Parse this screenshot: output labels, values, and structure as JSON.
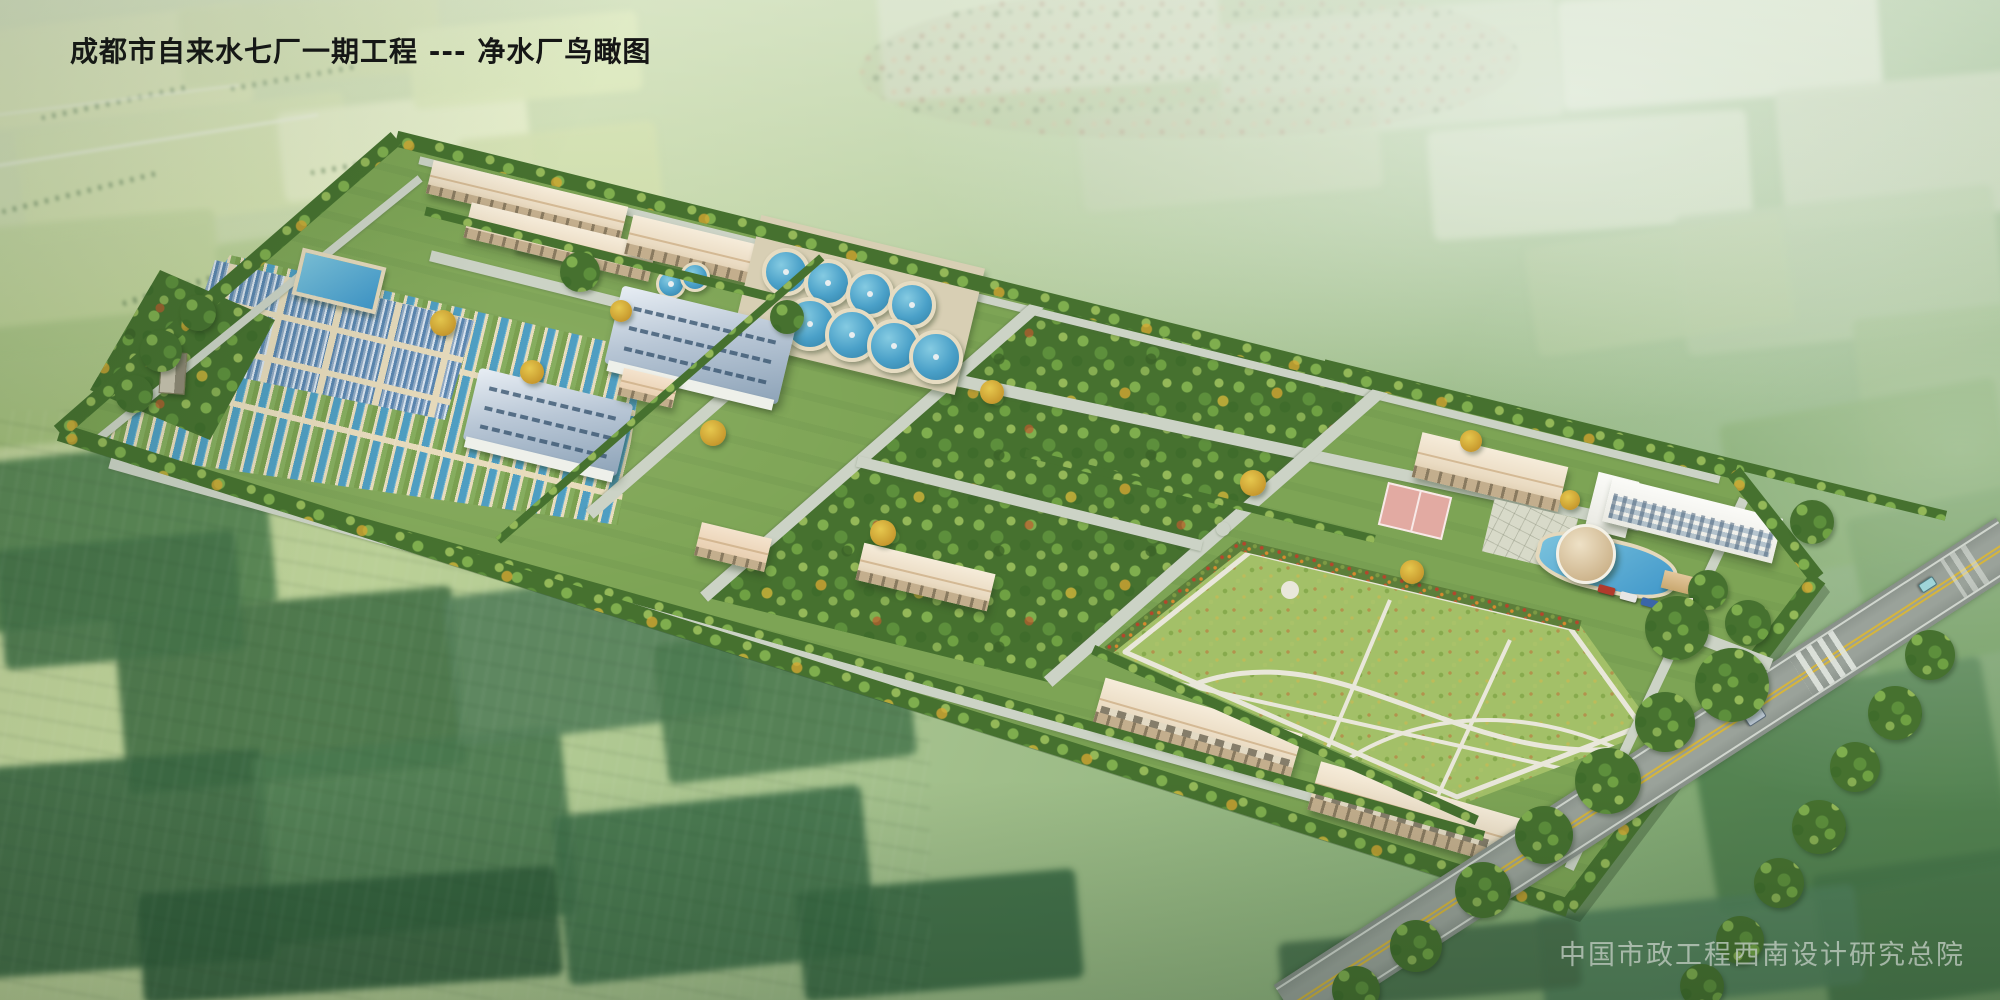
{
  "title": "成都市自来水七厂一期工程 --- 净水厂鸟瞰图",
  "attribution": "中国市政工程西南设计研究总院",
  "scene": {
    "type": "aerial-architectural-rendering",
    "subject": "bird's-eye view of a water purification plant surrounded by farmland",
    "landmarks": [
      "workshop-buildings",
      "circular-clarifiers",
      "sedimentation-basins",
      "covered-filter-basins",
      "filter-house-blue-roof",
      "elevated-pools",
      "water-tower",
      "orchard",
      "lawn-garden",
      "laboratory-building",
      "basketball-court",
      "office-building",
      "round-pavilion",
      "dormitory",
      "garage-buildings",
      "perimeter-hedge",
      "internal-roads",
      "main-road",
      "crosswalk",
      "entrance-gate",
      "village",
      "farm-fields"
    ],
    "colors": {
      "water_blue": "#4aa0c8",
      "basin_walkway_beige": "#e8dcbd",
      "building_beige": "#efe3cd",
      "blue_metal_roof": "#8da3b8",
      "site_grass_green": "#7da455",
      "orchard_green": "#46712f",
      "lawn_green": "#a3c068",
      "internal_road_gray": "#ccd3c6",
      "highway_gray": "#939b94",
      "highway_line_yellow": "#d6b53c",
      "hedge_dark_green": "#3f6b33",
      "court_pink": "#e2aaa2",
      "office_white": "#f4f4ef",
      "farmland_light": "#cfdf9f",
      "farmland_dark": "#3a6742"
    }
  }
}
